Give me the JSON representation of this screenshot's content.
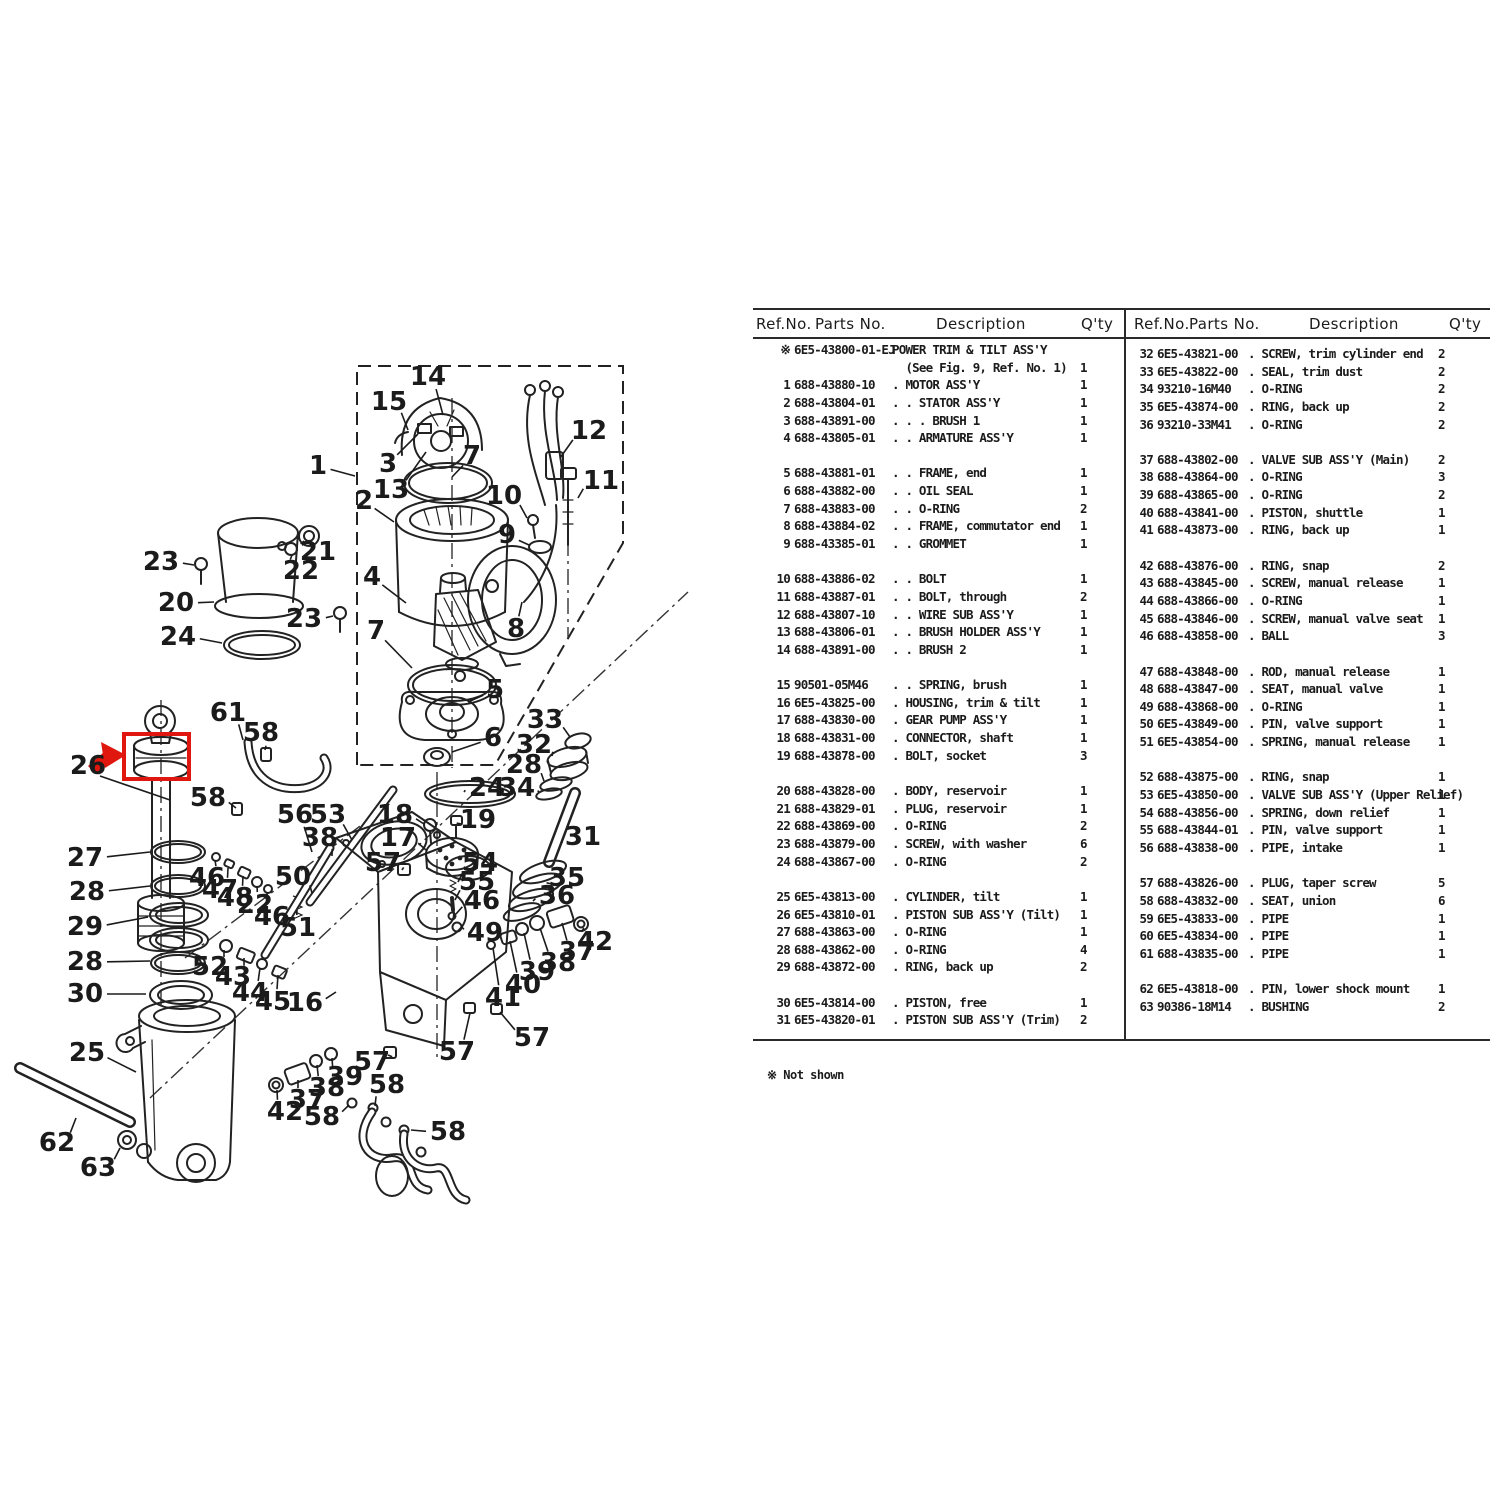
{
  "table": {
    "header": {
      "ref": "Ref.No.",
      "parts": "Parts No.",
      "desc": "Description",
      "qty": "Q'ty"
    },
    "left_rows": [
      {
        "r": "※",
        "p": "6E5-43800-01-EJ",
        "d": "POWER TRIM & TILT ASS'Y",
        "q": ""
      },
      {
        "r": "",
        "p": "",
        "d": "  (See Fig. 9, Ref. No. 1)",
        "q": "1"
      },
      {
        "r": "1",
        "p": "688-43880-10",
        "d": ". MOTOR ASS'Y",
        "q": "1"
      },
      {
        "r": "2",
        "p": "688-43804-01",
        "d": ". . STATOR ASS'Y",
        "q": "1"
      },
      {
        "r": "3",
        "p": "688-43891-00",
        "d": ". . . BRUSH 1",
        "q": "1"
      },
      {
        "r": "4",
        "p": "688-43805-01",
        "d": ". . ARMATURE ASS'Y",
        "q": "1"
      },
      null,
      {
        "r": "5",
        "p": "688-43881-01",
        "d": ". . FRAME, end",
        "q": "1"
      },
      {
        "r": "6",
        "p": "688-43882-00",
        "d": ". . OIL SEAL",
        "q": "1"
      },
      {
        "r": "7",
        "p": "688-43883-00",
        "d": ". . O-RING",
        "q": "2"
      },
      {
        "r": "8",
        "p": "688-43884-02",
        "d": ". . FRAME, commutator end",
        "q": "1"
      },
      {
        "r": "9",
        "p": "688-43385-01",
        "d": ". . GROMMET",
        "q": "1"
      },
      null,
      {
        "r": "10",
        "p": "688-43886-02",
        "d": ". . BOLT",
        "q": "1"
      },
      {
        "r": "11",
        "p": "688-43887-01",
        "d": ". . BOLT, through",
        "q": "2"
      },
      {
        "r": "12",
        "p": "688-43807-10",
        "d": ". . WIRE SUB ASS'Y",
        "q": "1"
      },
      {
        "r": "13",
        "p": "688-43806-01",
        "d": ". . BRUSH HOLDER ASS'Y",
        "q": "1"
      },
      {
        "r": "14",
        "p": "688-43891-00",
        "d": ". . BRUSH 2",
        "q": "1"
      },
      null,
      {
        "r": "15",
        "p": "90501-05M46",
        "d": ". . SPRING, brush",
        "q": "1"
      },
      {
        "r": "16",
        "p": "6E5-43825-00",
        "d": ". HOUSING, trim & tilt",
        "q": "1"
      },
      {
        "r": "17",
        "p": "688-43830-00",
        "d": ". GEAR PUMP ASS'Y",
        "q": "1"
      },
      {
        "r": "18",
        "p": "688-43831-00",
        "d": ". CONNECTOR, shaft",
        "q": "1"
      },
      {
        "r": "19",
        "p": "688-43878-00",
        "d": ". BOLT, socket",
        "q": "3"
      },
      null,
      {
        "r": "20",
        "p": "688-43828-00",
        "d": ". BODY, reservoir",
        "q": "1"
      },
      {
        "r": "21",
        "p": "688-43829-01",
        "d": ". PLUG, reservoir",
        "q": "1"
      },
      {
        "r": "22",
        "p": "688-43869-00",
        "d": ". O-RING",
        "q": "2"
      },
      {
        "r": "23",
        "p": "688-43879-00",
        "d": ". SCREW, with washer",
        "q": "6"
      },
      {
        "r": "24",
        "p": "688-43867-00",
        "d": ". O-RING",
        "q": "2"
      },
      null,
      {
        "r": "25",
        "p": "6E5-43813-00",
        "d": ". CYLINDER, tilt",
        "q": "1"
      },
      {
        "r": "26",
        "p": "6E5-43810-01",
        "d": ". PISTON SUB ASS'Y (Tilt)",
        "q": "1"
      },
      {
        "r": "27",
        "p": "688-43863-00",
        "d": ". O-RING",
        "q": "1"
      },
      {
        "r": "28",
        "p": "688-43862-00",
        "d": ". O-RING",
        "q": "4"
      },
      {
        "r": "29",
        "p": "688-43872-00",
        "d": ". RING, back up",
        "q": "2"
      },
      null,
      {
        "r": "30",
        "p": "6E5-43814-00",
        "d": ". PISTON, free",
        "q": "1"
      },
      {
        "r": "31",
        "p": "6E5-43820-01",
        "d": ". PISTON SUB ASS'Y (Trim)",
        "q": "2"
      }
    ],
    "right_rows": [
      {
        "r": "32",
        "p": "6E5-43821-00",
        "d": ". SCREW, trim cylinder end",
        "q": "2"
      },
      {
        "r": "33",
        "p": "6E5-43822-00",
        "d": ". SEAL, trim dust",
        "q": "2"
      },
      {
        "r": "34",
        "p": "93210-16M40",
        "d": ". O-RING",
        "q": "2"
      },
      {
        "r": "35",
        "p": "6E5-43874-00",
        "d": ". RING, back up",
        "q": "2"
      },
      {
        "r": "36",
        "p": "93210-33M41",
        "d": ". O-RING",
        "q": "2"
      },
      null,
      {
        "r": "37",
        "p": "688-43802-00",
        "d": ". VALVE SUB ASS'Y (Main)",
        "q": "2"
      },
      {
        "r": "38",
        "p": "688-43864-00",
        "d": ". O-RING",
        "q": "3"
      },
      {
        "r": "39",
        "p": "688-43865-00",
        "d": ". O-RING",
        "q": "2"
      },
      {
        "r": "40",
        "p": "688-43841-00",
        "d": ". PISTON, shuttle",
        "q": "1"
      },
      {
        "r": "41",
        "p": "688-43873-00",
        "d": ". RING, back up",
        "q": "1"
      },
      null,
      {
        "r": "42",
        "p": "688-43876-00",
        "d": ". RING, snap",
        "q": "2"
      },
      {
        "r": "43",
        "p": "688-43845-00",
        "d": ". SCREW, manual release",
        "q": "1"
      },
      {
        "r": "44",
        "p": "688-43866-00",
        "d": ". O-RING",
        "q": "1"
      },
      {
        "r": "45",
        "p": "688-43846-00",
        "d": ". SCREW, manual valve seat",
        "q": "1"
      },
      {
        "r": "46",
        "p": "688-43858-00",
        "d": ". BALL",
        "q": "3"
      },
      null,
      {
        "r": "47",
        "p": "688-43848-00",
        "d": ". ROD, manual release",
        "q": "1"
      },
      {
        "r": "48",
        "p": "688-43847-00",
        "d": ". SEAT, manual valve",
        "q": "1"
      },
      {
        "r": "49",
        "p": "688-43868-00",
        "d": ". O-RING",
        "q": "1"
      },
      {
        "r": "50",
        "p": "6E5-43849-00",
        "d": ". PIN, valve support",
        "q": "1"
      },
      {
        "r": "51",
        "p": "6E5-43854-00",
        "d": ". SPRING, manual release",
        "q": "1"
      },
      null,
      {
        "r": "52",
        "p": "688-43875-00",
        "d": ". RING, snap",
        "q": "1"
      },
      {
        "r": "53",
        "p": "6E5-43850-00",
        "d": ". VALVE SUB ASS'Y (Upper Relief)",
        "q": "1"
      },
      {
        "r": "54",
        "p": "688-43856-00",
        "d": ". SPRING, down relief",
        "q": "1"
      },
      {
        "r": "55",
        "p": "688-43844-01",
        "d": ". PIN, valve support",
        "q": "1"
      },
      {
        "r": "56",
        "p": "688-43838-00",
        "d": ". PIPE, intake",
        "q": "1"
      },
      null,
      {
        "r": "57",
        "p": "688-43826-00",
        "d": ". PLUG, taper screw",
        "q": "5"
      },
      {
        "r": "58",
        "p": "688-43832-00",
        "d": ". SEAT, union",
        "q": "6"
      },
      {
        "r": "59",
        "p": "6E5-43833-00",
        "d": ". PIPE",
        "q": "1"
      },
      {
        "r": "60",
        "p": "6E5-43834-00",
        "d": ". PIPE",
        "q": "1"
      },
      {
        "r": "61",
        "p": "688-43835-00",
        "d": ". PIPE",
        "q": "1"
      },
      null,
      {
        "r": "62",
        "p": "6E5-43818-00",
        "d": ". PIN, lower shock mount",
        "q": "1"
      },
      {
        "r": "63",
        "p": "90386-18M14",
        "d": ". BUSHING",
        "q": "2"
      }
    ],
    "footnote": "※ Not shown"
  },
  "diagram": {
    "highlight": {
      "ref": "26",
      "color": "#e0170f"
    },
    "callouts": [
      {
        "t": "14",
        "x": 428,
        "y": 377,
        "ex": 443,
        "ey": 415
      },
      {
        "t": "15",
        "x": 389,
        "y": 402,
        "ex": 408,
        "ey": 430
      },
      {
        "t": "1",
        "x": 318,
        "y": 466,
        "ex": 355,
        "ey": 476
      },
      {
        "t": "3",
        "x": 388,
        "y": 464,
        "ex": 418,
        "ey": 434
      },
      {
        "t": "13",
        "x": 391,
        "y": 490,
        "ex": 426,
        "ey": 452
      },
      {
        "t": "2",
        "x": 364,
        "y": 501,
        "ex": 394,
        "ey": 522
      },
      {
        "t": "7",
        "x": 472,
        "y": 456,
        "ex": 452,
        "ey": 477
      },
      {
        "t": "12",
        "x": 589,
        "y": 431,
        "ex": 560,
        "ey": 458
      },
      {
        "t": "11",
        "x": 601,
        "y": 481,
        "ex": 578,
        "ey": 498
      },
      {
        "t": "10",
        "x": 504,
        "y": 496,
        "ex": 527,
        "ey": 518
      },
      {
        "t": "9",
        "x": 507,
        "y": 535,
        "ex": 529,
        "ey": 545
      },
      {
        "t": "8",
        "x": 516,
        "y": 629,
        "ex": 522,
        "ey": 602
      },
      {
        "t": "21",
        "x": 318,
        "y": 552,
        "ex": 304,
        "ey": 541
      },
      {
        "t": "22",
        "x": 301,
        "y": 571,
        "ex": 292,
        "ey": 555
      },
      {
        "t": "23",
        "x": 161,
        "y": 562,
        "ex": 194,
        "ey": 565
      },
      {
        "t": "20",
        "x": 176,
        "y": 603,
        "ex": 214,
        "ey": 602
      },
      {
        "t": "24",
        "x": 178,
        "y": 637,
        "ex": 222,
        "ey": 643
      },
      {
        "t": "23",
        "x": 304,
        "y": 619,
        "ex": 333,
        "ey": 616
      },
      {
        "t": "4",
        "x": 372,
        "y": 577,
        "ex": 406,
        "ey": 603
      },
      {
        "t": "7",
        "x": 376,
        "y": 631,
        "ex": 412,
        "ey": 668
      },
      {
        "t": "5",
        "x": 495,
        "y": 690,
        "ex": 468,
        "ey": 702
      },
      {
        "t": "6",
        "x": 493,
        "y": 738,
        "ex": 452,
        "ey": 752
      },
      {
        "t": "61",
        "x": 228,
        "y": 713,
        "ex": 243,
        "ey": 740
      },
      {
        "t": "58",
        "x": 261,
        "y": 733,
        "ex": 265,
        "ey": 750
      },
      {
        "t": "26",
        "x": 88,
        "y": 766,
        "ex": null,
        "ey": null
      },
      {
        "t": "58",
        "x": 208,
        "y": 798,
        "ex": 236,
        "ey": 808
      },
      {
        "t": "56",
        "x": 295,
        "y": 815,
        "ex": 312,
        "ey": 852
      },
      {
        "t": "53",
        "x": 328,
        "y": 815,
        "ex": 352,
        "ey": 840
      },
      {
        "t": "38",
        "x": 320,
        "y": 838,
        "ex": 332,
        "ey": 856
      },
      {
        "t": "18",
        "x": 395,
        "y": 815,
        "ex": 424,
        "ey": 824
      },
      {
        "t": "19",
        "x": 478,
        "y": 820,
        "ex": 462,
        "ey": 824
      },
      {
        "t": "17",
        "x": 398,
        "y": 838,
        "ex": 426,
        "ey": 850
      },
      {
        "t": "57",
        "x": 383,
        "y": 863,
        "ex": 402,
        "ey": 870
      },
      {
        "t": "54",
        "x": 480,
        "y": 863,
        "ex": 458,
        "ey": 882
      },
      {
        "t": "55",
        "x": 477,
        "y": 882,
        "ex": 455,
        "ey": 900
      },
      {
        "t": "46",
        "x": 482,
        "y": 901,
        "ex": 456,
        "ey": 914
      },
      {
        "t": "49",
        "x": 485,
        "y": 933,
        "ex": 461,
        "ey": 926
      },
      {
        "t": "24",
        "x": 487,
        "y": 788,
        "ex": 464,
        "ey": 792
      },
      {
        "t": "34",
        "x": 517,
        "y": 788,
        "ex": 538,
        "ey": 792
      },
      {
        "t": "33",
        "x": 545,
        "y": 720,
        "ex": 570,
        "ey": 737
      },
      {
        "t": "32",
        "x": 534,
        "y": 745,
        "ex": 552,
        "ey": 756
      },
      {
        "t": "28",
        "x": 524,
        "y": 765,
        "ex": 544,
        "ey": 781
      },
      {
        "t": "31",
        "x": 583,
        "y": 837,
        "ex": 562,
        "ey": 843
      },
      {
        "t": "35",
        "x": 567,
        "y": 878,
        "ex": 552,
        "ey": 884
      },
      {
        "t": "36",
        "x": 557,
        "y": 896,
        "ex": 533,
        "ey": 901
      },
      {
        "t": "42",
        "x": 595,
        "y": 942,
        "ex": 584,
        "ey": 928
      },
      {
        "t": "37",
        "x": 577,
        "y": 952,
        "ex": 562,
        "ey": 923
      },
      {
        "t": "38",
        "x": 558,
        "y": 963,
        "ex": 540,
        "ey": 928
      },
      {
        "t": "39",
        "x": 537,
        "y": 972,
        "ex": 524,
        "ey": 933
      },
      {
        "t": "40",
        "x": 523,
        "y": 985,
        "ex": 510,
        "ey": 941
      },
      {
        "t": "41",
        "x": 503,
        "y": 998,
        "ex": 493,
        "ey": 948
      },
      {
        "t": "16",
        "x": 305,
        "y": 1003,
        "ex": 336,
        "ey": 992
      },
      {
        "t": "50",
        "x": 293,
        "y": 877,
        "ex": 312,
        "ey": 893
      },
      {
        "t": "51",
        "x": 298,
        "y": 928,
        "ex": 297,
        "ey": 910
      },
      {
        "t": "46",
        "x": 207,
        "y": 878,
        "ex": 215,
        "ey": 860
      },
      {
        "t": "47",
        "x": 220,
        "y": 890,
        "ex": 228,
        "ey": 868
      },
      {
        "t": "48",
        "x": 235,
        "y": 898,
        "ex": 243,
        "ey": 876
      },
      {
        "t": "22",
        "x": 255,
        "y": 905,
        "ex": 257,
        "ey": 886
      },
      {
        "t": "46",
        "x": 272,
        "y": 917,
        "ex": 267,
        "ey": 892
      },
      {
        "t": "52",
        "x": 210,
        "y": 967,
        "ex": 224,
        "ey": 950
      },
      {
        "t": "43",
        "x": 233,
        "y": 977,
        "ex": 244,
        "ey": 958
      },
      {
        "t": "44",
        "x": 250,
        "y": 993,
        "ex": 260,
        "ey": 968
      },
      {
        "t": "45",
        "x": 273,
        "y": 1002,
        "ex": 278,
        "ey": 975
      },
      {
        "t": "27",
        "x": 85,
        "y": 858,
        "ex": 150,
        "ey": 852
      },
      {
        "t": "28",
        "x": 87,
        "y": 892,
        "ex": 150,
        "ey": 886
      },
      {
        "t": "29",
        "x": 85,
        "y": 927,
        "ex": 148,
        "ey": 917
      },
      {
        "t": "28",
        "x": 85,
        "y": 962,
        "ex": 150,
        "ey": 961
      },
      {
        "t": "30",
        "x": 85,
        "y": 994,
        "ex": 146,
        "ey": 994
      },
      {
        "t": "25",
        "x": 87,
        "y": 1053,
        "ex": 136,
        "ey": 1072
      },
      {
        "t": "62",
        "x": 57,
        "y": 1143,
        "ex": 76,
        "ey": 1118
      },
      {
        "t": "63",
        "x": 98,
        "y": 1168,
        "ex": 120,
        "ey": 1148
      },
      {
        "t": "39",
        "x": 345,
        "y": 1077,
        "ex": 332,
        "ey": 1058
      },
      {
        "t": "38",
        "x": 327,
        "y": 1088,
        "ex": 317,
        "ey": 1065
      },
      {
        "t": "37",
        "x": 307,
        "y": 1100,
        "ex": 298,
        "ey": 1080
      },
      {
        "t": "42",
        "x": 285,
        "y": 1112,
        "ex": 277,
        "ey": 1090
      },
      {
        "t": "58",
        "x": 322,
        "y": 1117,
        "ex": 349,
        "ey": 1105
      },
      {
        "t": "57",
        "x": 372,
        "y": 1062,
        "ex": 388,
        "ey": 1055
      },
      {
        "t": "58",
        "x": 387,
        "y": 1085,
        "ex": 375,
        "ey": 1106
      },
      {
        "t": "58",
        "x": 448,
        "y": 1132,
        "ex": 411,
        "ey": 1130
      },
      {
        "t": "57",
        "x": 457,
        "y": 1052,
        "ex": 470,
        "ey": 1013
      },
      {
        "t": "57",
        "x": 532,
        "y": 1038,
        "ex": 500,
        "ey": 1012
      }
    ]
  }
}
